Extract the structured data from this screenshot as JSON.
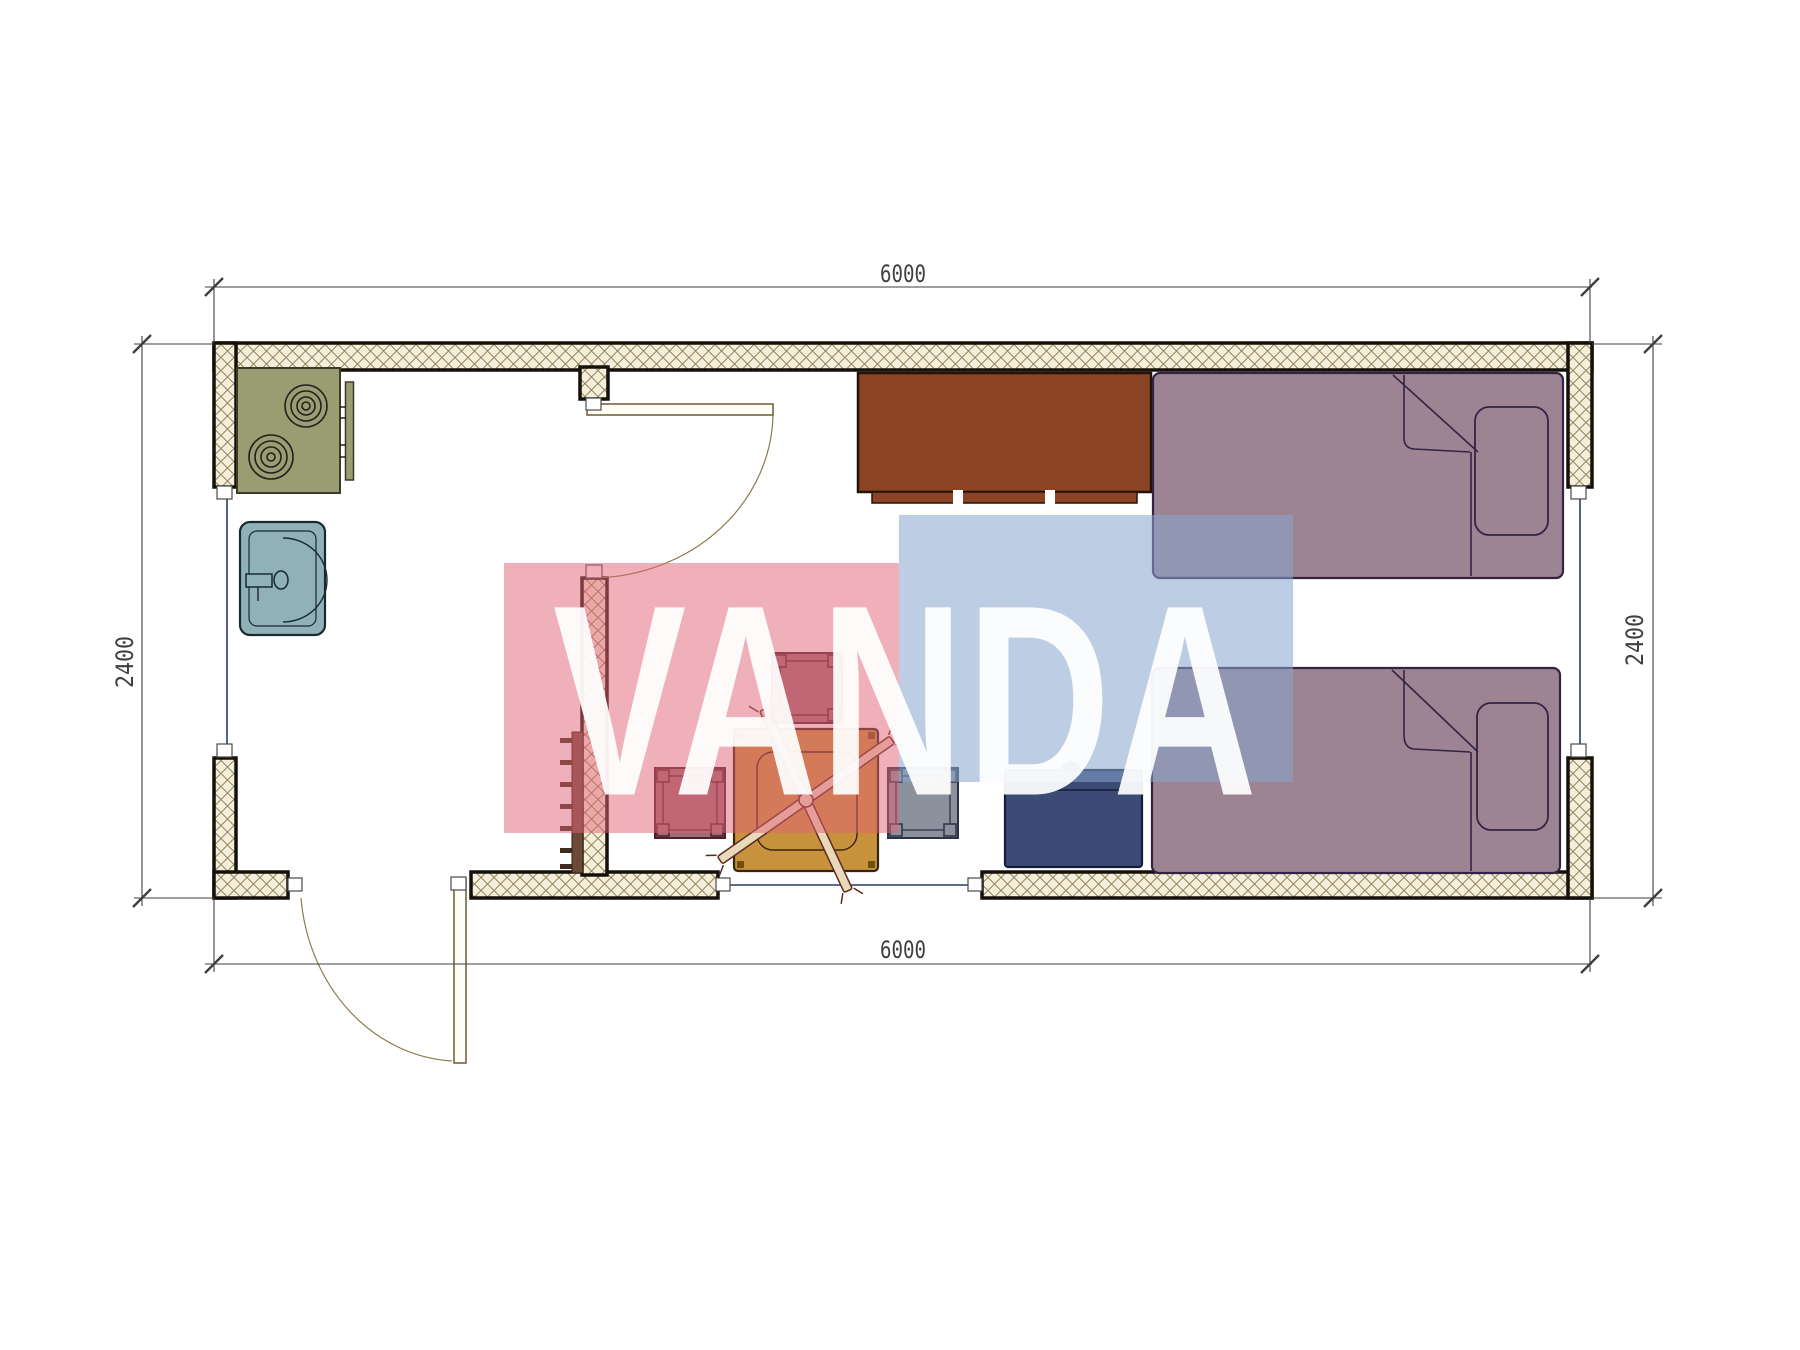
{
  "drawing": {
    "type": "architectural-floor-plan",
    "units": "mm",
    "dimensions": {
      "top": "6000",
      "bottom": "6000",
      "left": "2400",
      "right": "2400"
    },
    "watermark": {
      "text": "VANDA",
      "red_block_color": "#e26175",
      "blue_block_color": "#87a5cd",
      "letter_color": "#ffffff"
    },
    "colors": {
      "wall_hatch_line": "#8c7f55",
      "wall_hatch_bg": "#f5eeda",
      "wall_outline": "#15100a",
      "stove": "#9a9c72",
      "sink": "#8fb1b7",
      "cabinet": "#8a4423",
      "bed": "#9d8493",
      "table": "#c8923c",
      "stool_mauve": "#9f6b75",
      "stool_gray": "#8c929d",
      "chest": "#3c4b76",
      "door": "#8a7b4a",
      "window_line": "#2b3a6b",
      "dimension_line": "#3f3f3f"
    },
    "furniture": [
      {
        "name": "stove"
      },
      {
        "name": "sink"
      },
      {
        "name": "cabinet"
      },
      {
        "name": "bed-top"
      },
      {
        "name": "bed-bottom"
      },
      {
        "name": "table"
      },
      {
        "name": "stool-top"
      },
      {
        "name": "stool-left"
      },
      {
        "name": "stool-right"
      },
      {
        "name": "storage-chest"
      },
      {
        "name": "wall-ladder"
      },
      {
        "name": "entry-door"
      },
      {
        "name": "interior-door"
      },
      {
        "name": "window-left"
      },
      {
        "name": "window-right"
      },
      {
        "name": "window-bottom"
      }
    ]
  }
}
